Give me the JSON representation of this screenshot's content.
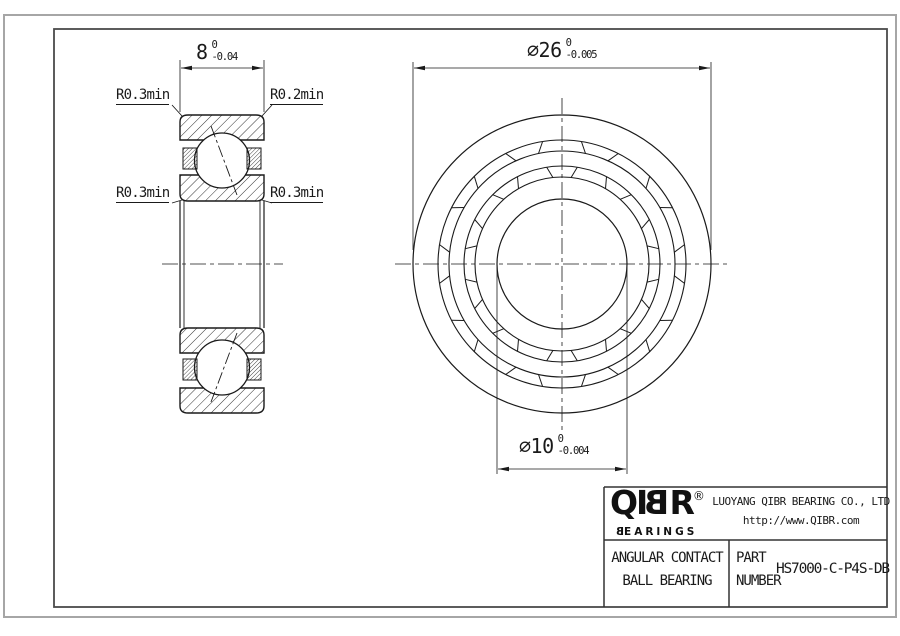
{
  "section_view": {
    "width_dim": {
      "value": "8",
      "tol_upper": "0",
      "tol_lower": "-0.04"
    },
    "fillet_top_left": "R0.3min",
    "fillet_top_right": "R0.2min",
    "fillet_bottom_left": "R0.3min",
    "fillet_bottom_right": "R0.3min"
  },
  "front_view": {
    "outer_diameter_dim": {
      "value": "∅26",
      "tol_upper": "0",
      "tol_lower": "-0.005"
    },
    "bore_diameter_dim": {
      "value": "∅10",
      "tol_upper": "0",
      "tol_lower": "-0.004"
    }
  },
  "title_block": {
    "logo_text": "QIBR",
    "logo_registered": "®",
    "logo_subtext": "BEARINGS",
    "company_name": "LUOYANG QIBR BEARING CO., LTD",
    "website": "http://www.QIBR.com",
    "product_name_line1": "ANGULAR CONTACT",
    "product_name_line2": "BALL BEARING",
    "part_label_line1": "PART",
    "part_label_line2": "NUMBER",
    "part_number": "HS7000-C-P4S-DB"
  },
  "colors": {
    "line": "#1a1a1a",
    "frame_outer": "#a6a6a6",
    "frame_inner": "#4a4a4a"
  }
}
